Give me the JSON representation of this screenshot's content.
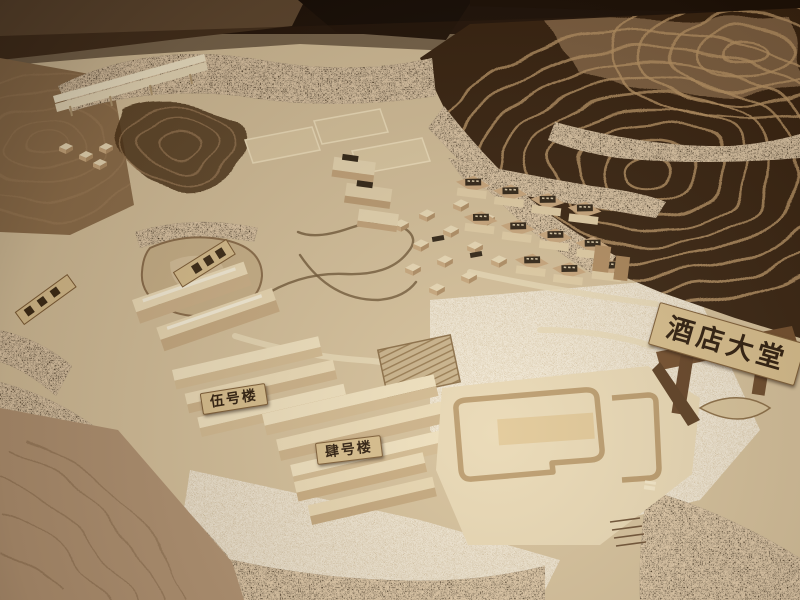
{
  "signs": {
    "hotel_lobby": "酒店大堂",
    "building_no5": "伍号楼",
    "building_no4": "肆号楼"
  },
  "colors": {
    "base-wood": "#d5c19c",
    "pale-wood": "#e9d9b6",
    "floor-dark": "#1c1109",
    "terrace-dark": "#362210",
    "terrace-ridge": "#b99566",
    "tree-dark": "#42301c",
    "sand": "#b09272",
    "sign-bg": "#d8bf8e",
    "sign-text": "#2b1b0c",
    "plaque-dark": "#2e2315"
  }
}
